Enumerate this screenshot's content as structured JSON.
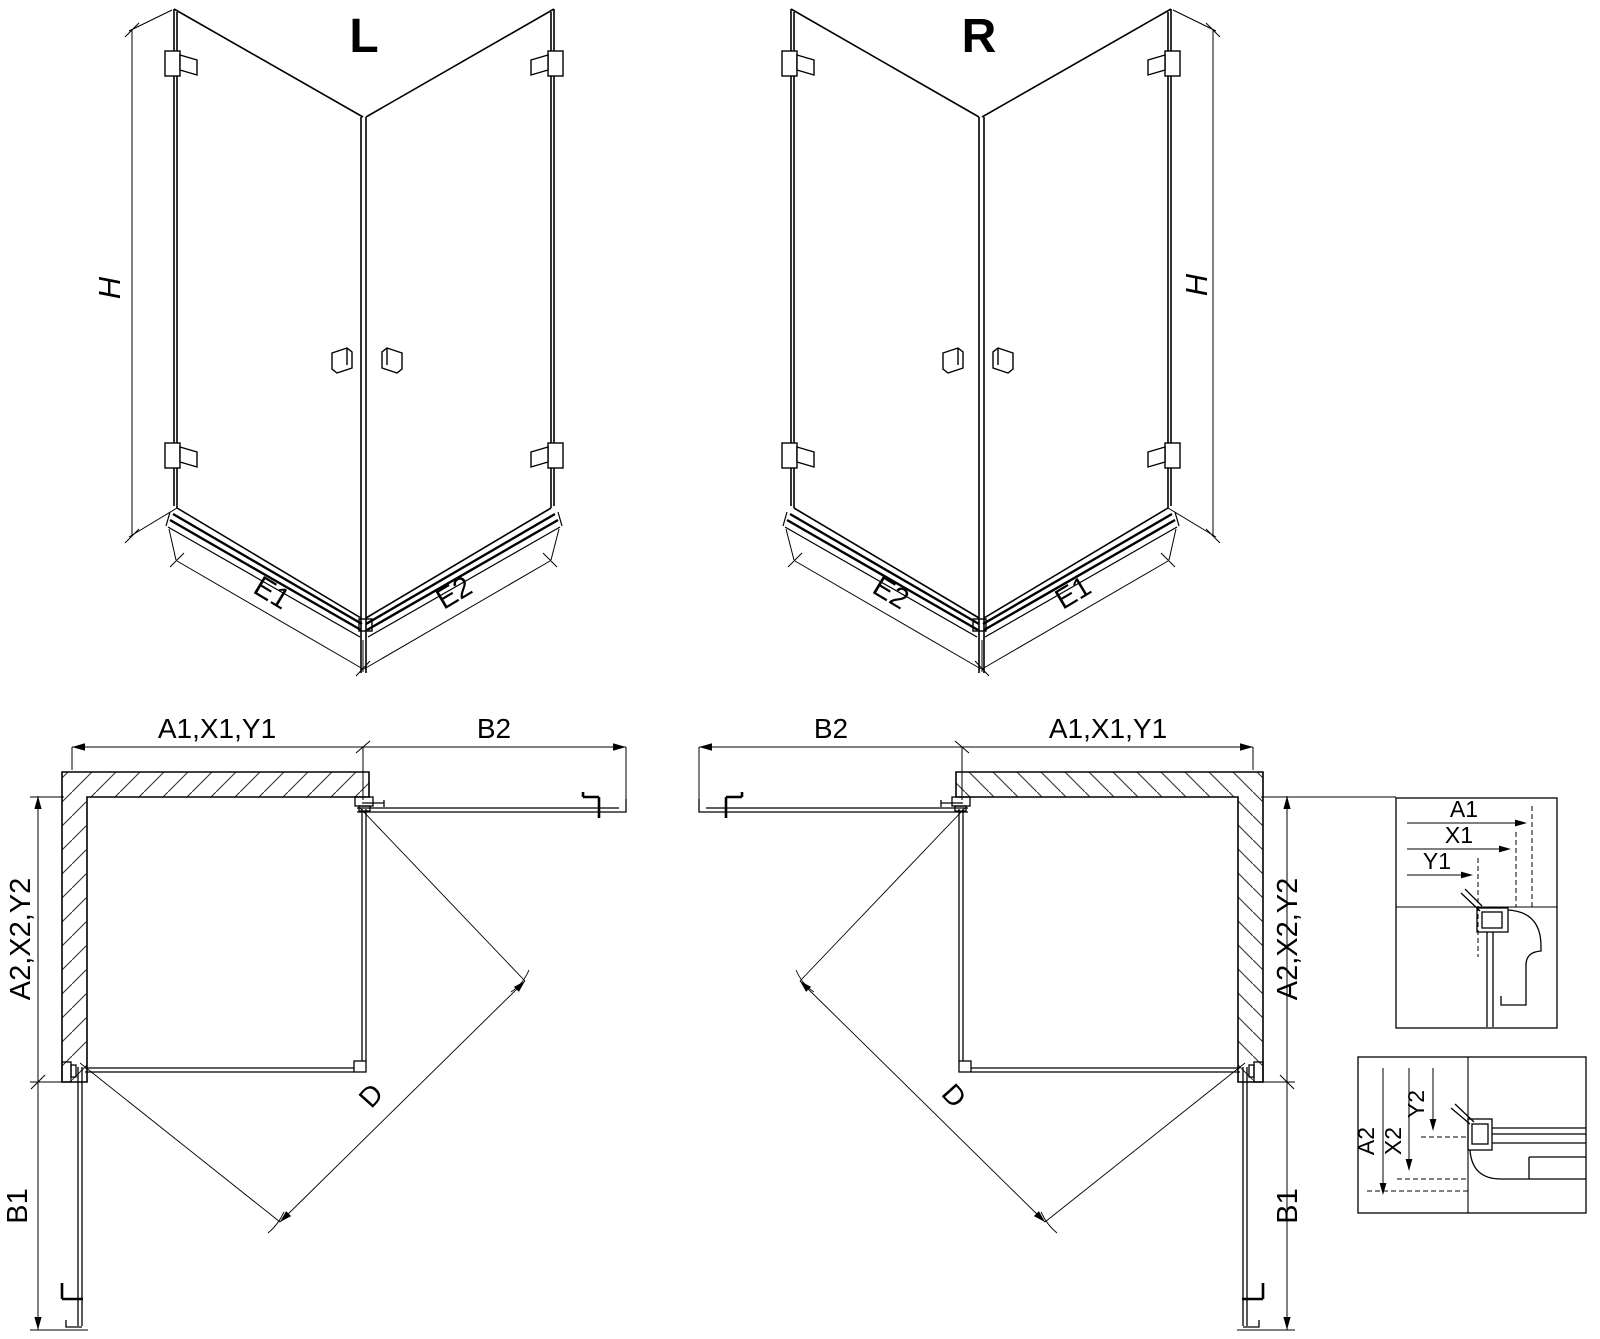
{
  "colors": {
    "ink": "#000000",
    "background": "#ffffff"
  },
  "views": {
    "iso_left": {
      "title": "L",
      "height_label": "H",
      "edge_left_label": "E1",
      "edge_right_label": "E2"
    },
    "iso_right": {
      "title": "R",
      "height_label": "H",
      "edge_left_label": "E2",
      "edge_right_label": "E1"
    },
    "plan_left": {
      "top_left_dim": "A1,X1,Y1",
      "top_right_dim": "B2",
      "side_dim": "A2,X2,Y2",
      "side_bottom_dim": "B1",
      "diagonal_dim": "D"
    },
    "plan_right": {
      "top_left_dim": "B2",
      "top_right_dim": "A1,X1,Y1",
      "side_dim": "A2,X2,Y2",
      "side_bottom_dim": "B1",
      "diagonal_dim": "D"
    },
    "detail_wall_profile_horizontal": {
      "dim_a": "A1",
      "dim_x": "X1",
      "dim_y": "Y1"
    },
    "detail_wall_profile_vertical": {
      "dim_a": "A2",
      "dim_x": "X2",
      "dim_y": "Y2"
    }
  }
}
